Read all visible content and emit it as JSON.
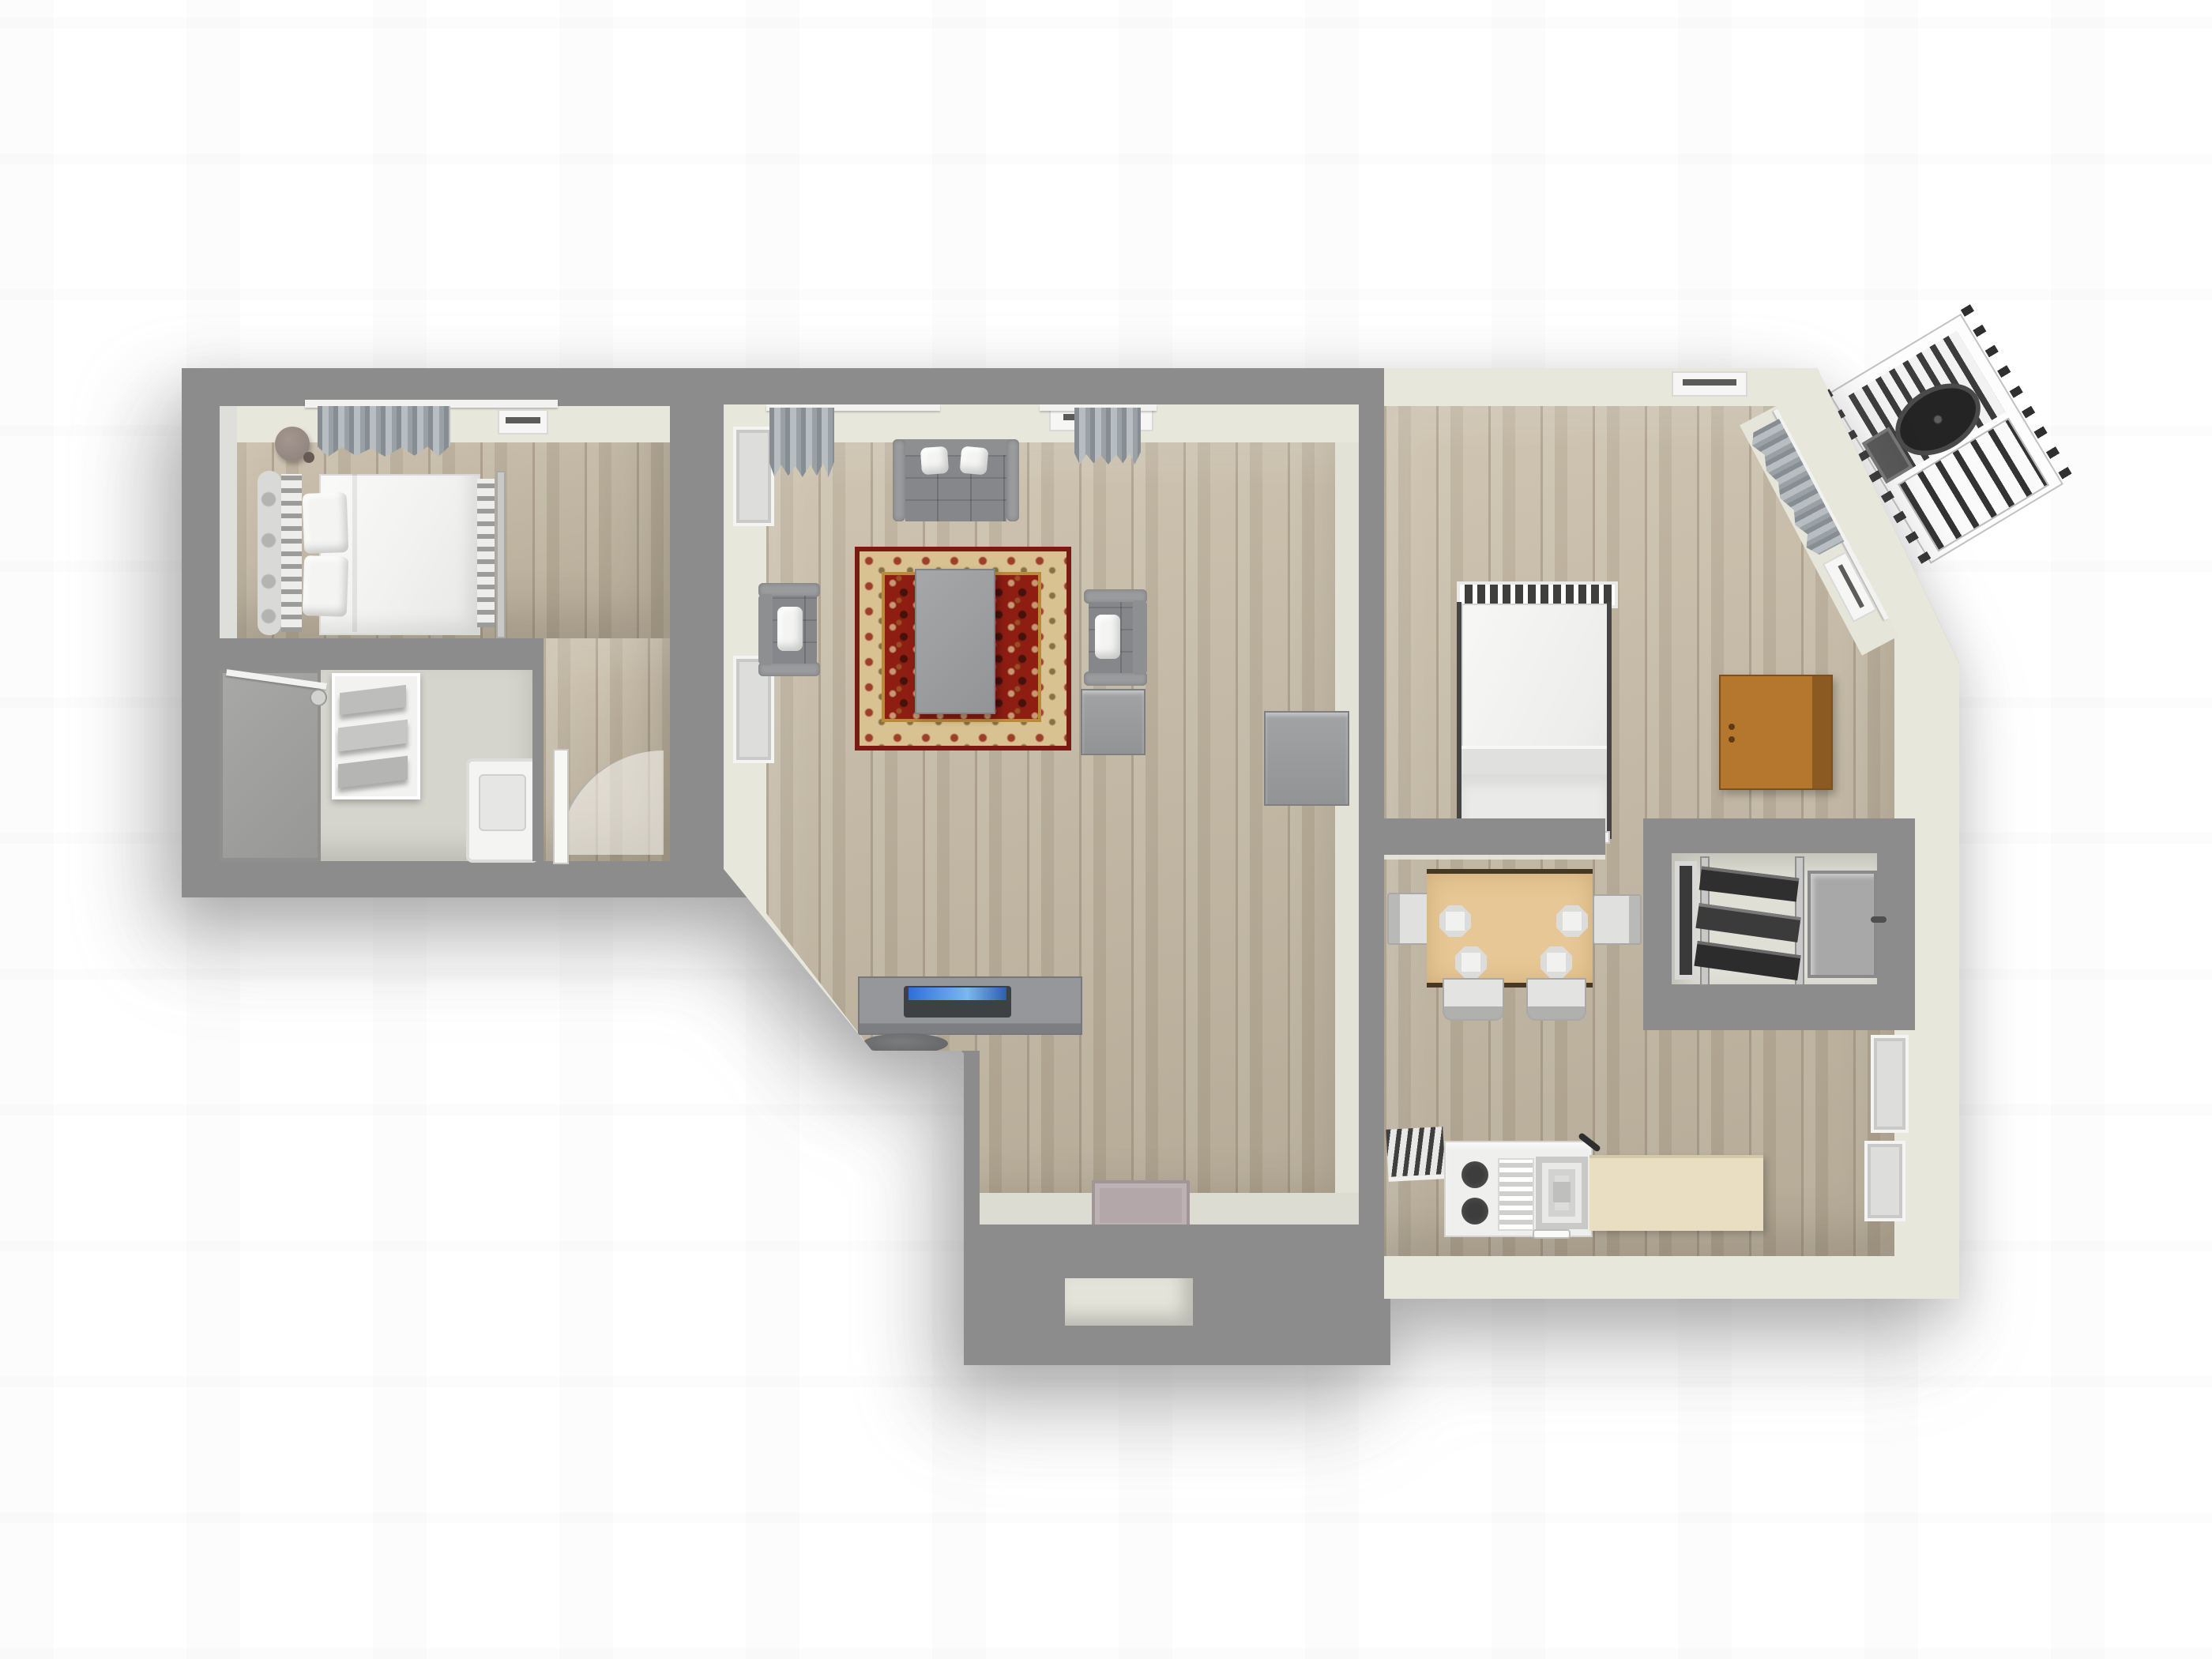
{
  "meta": {
    "view": "3d-apartment-floor-plan-top-down",
    "visible_text": "none"
  },
  "palette": {
    "background": "#ffffff",
    "wall_top": "#8c8c8c",
    "wall_inner_face": "#e8e7dc",
    "wood_floor": "#c0b5a1",
    "bath_floor": "#d6d5cd",
    "rug_field_red": "#8e1d12",
    "rug_border_beige": "#d9c291",
    "rug_guard_gold": "#b98c3a",
    "dining_table_tan": "#e7c795",
    "wardrobe_brown": "#b5772e",
    "laptop_screen_blue": "#3f7fd1",
    "fire_escape_dark": "#2b2b2b"
  },
  "rooms": [
    {
      "id": "bedroom-left",
      "furniture": [
        "double-bed-ornate-headboard",
        "two-pillows",
        "round-side-table",
        "curtains",
        "radiator",
        "wall-cabinet-brown"
      ]
    },
    {
      "id": "bathroom",
      "furniture": [
        "shower-with-rod",
        "towel-shelf-rack",
        "toilet",
        "toilet-brush"
      ]
    },
    {
      "id": "hall",
      "furniture": [
        "open-door-with-swing-arc"
      ]
    },
    {
      "id": "living-room",
      "furniture": [
        "two-seat-sofa",
        "armchair-west",
        "armchair-east",
        "side-cabinet",
        "sideboard-east",
        "oriental-rug",
        "coffee-table",
        "desk",
        "laptop",
        "desk-chair",
        "entry-mat",
        "radiator-top-wall",
        "radiator-diagonal-wall",
        "curtains-two-sets",
        "windows-west-two"
      ]
    },
    {
      "id": "bedroom-right",
      "furniture": [
        "double-bed-slat-headboard",
        "wardrobe-brown",
        "curtains-on-diagonal-wall",
        "radiator"
      ]
    },
    {
      "id": "dining-area",
      "furniture": [
        "square-table-tan",
        "four-chairs",
        "four-plates"
      ]
    },
    {
      "id": "storage-room",
      "furniture": [
        "tilted-shelf-unit",
        "gray-cabinet-with-knob",
        "dark-door-frame"
      ]
    },
    {
      "id": "kitchen",
      "furniture": [
        "dish-drying-rack",
        "two-burner-stove",
        "drainboard",
        "sink",
        "faucet",
        "beige-counter",
        "knife"
      ]
    }
  ],
  "exterior": {
    "fire_escape_top_right": true,
    "entry_vestibule_alcove_bottom": true
  }
}
